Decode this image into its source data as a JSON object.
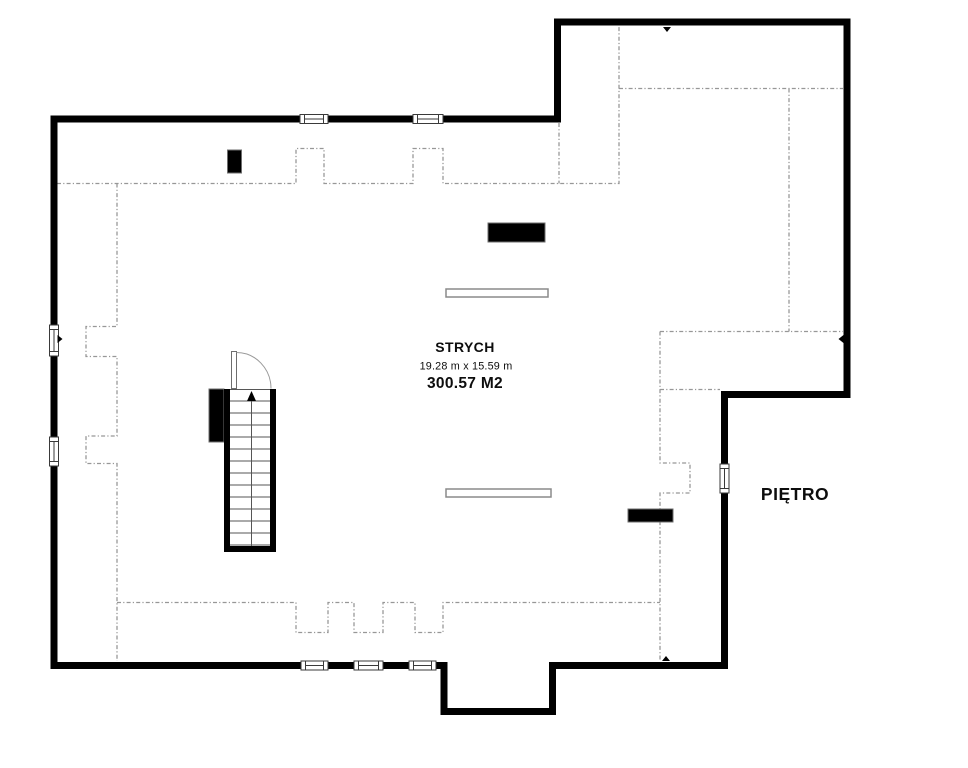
{
  "plan": {
    "room": {
      "name": "STRYCH",
      "dimensions": "19.28 m x 15.59 m",
      "area": "300.57 M2"
    },
    "floor_label": "PIĘTRO",
    "colors": {
      "background": "#ffffff",
      "wall": "#000000",
      "dashed": "#979797",
      "thin_line": "#565656",
      "text": "#0d0d0d"
    },
    "geometry": {
      "outer_wall_path": "M 54 665.5 L 54 119 L 557.5 119 L 557.5 22 L 847 22 L 847 394.5 L 724.5 394.5 L 724.5 665.5 L 552.5 665.5 L 552.5 711.5 L 444 711.5 L 444 665.5 L 54 665.5 Z",
      "dashed_boundary_paths": [
        "M 57 183.5 L 296 183.5 L 296 148.5 L 324 148.5 L 324 183.5 L 413 183.5 L 413 148.5 L 443 148.5 L 443 183.5 L 619 183.5 L 619 27",
        "M 559 123 L 559 183.5",
        "M 619 88.5 L 843 88.5",
        "M 789 88.5 L 789 331.5",
        "M 660 331.5 L 843 331.5",
        "M 660 331.5 L 660 463 L 690 463 L 690 493 L 660 493 L 660 661",
        "M 660 389.5 L 720 389.5",
        "M 117 183.5 L 117 326.5 L 86 326.5 L 86 356.5 L 117 356.5 L 117 436 L 86 436 L 86 463.5 L 117 463.5 L 117 661",
        "M 117 602.5 L 296 602.5 L 296 632.5 L 328 632.5 L 328 602.5 L 354 602.5 L 354 632.5 L 383 632.5 L 383 602.5 L 415 602.5 L 415 632.5 L 443 632.5 L 443 602.5 L 660 602.5"
      ],
      "windows": [
        {
          "rect": [
            300,
            114.5,
            28,
            9
          ],
          "orientation": "h"
        },
        {
          "rect": [
            413,
            114.5,
            30,
            9
          ],
          "orientation": "h"
        },
        {
          "rect": [
            49.5,
            325,
            9,
            31
          ],
          "orientation": "v"
        },
        {
          "rect": [
            49.5,
            437,
            9,
            29
          ],
          "orientation": "v"
        },
        {
          "rect": [
            720,
            464,
            9,
            29
          ],
          "orientation": "v"
        },
        {
          "rect": [
            301,
            661,
            27,
            9
          ],
          "orientation": "h"
        },
        {
          "rect": [
            354,
            661,
            29,
            9
          ],
          "orientation": "h"
        },
        {
          "rect": [
            409,
            661,
            27,
            9
          ],
          "orientation": "h"
        }
      ],
      "chimneys": [
        [
          227.5,
          150,
          14,
          23
        ],
        [
          488,
          223,
          57,
          19
        ],
        [
          628,
          509,
          45,
          13
        ]
      ],
      "skylights": [
        [
          446,
          289,
          102,
          8
        ],
        [
          446,
          489,
          105,
          8
        ]
      ],
      "section_ticks": [
        "M 663 27 L 671 27 L 667 32 Z",
        "M 57.5 335 L 57.5 343 L 62.5 339 Z",
        "M 843.5 335 L 843.5 343 L 838.5 339 Z",
        "M 662 661 L 670 661 L 666 656 Z"
      ],
      "stairs": {
        "side_block": [
          209,
          389,
          15,
          53
        ],
        "enclosure_walls": [
          [
            224,
            389,
            6,
            163
          ],
          [
            270,
            389,
            6,
            163
          ],
          [
            224,
            546,
            52,
            6
          ]
        ],
        "treads": {
          "x1": 230,
          "x2": 270,
          "y_start": 401,
          "step": 12,
          "count": 13
        },
        "threshold_y": 389.5,
        "centerline": {
          "x": 251.5,
          "y1": 398,
          "y2": 546
        },
        "direction_arrow": "M 247 401 L 256 401 L 251.5 391 Z",
        "door": {
          "leaf": [
            231.5,
            351.5,
            5,
            37
          ],
          "swing_arc": "M 236.5 352.5 A 34.5 36 0 0 1 271 388.5"
        }
      }
    }
  }
}
